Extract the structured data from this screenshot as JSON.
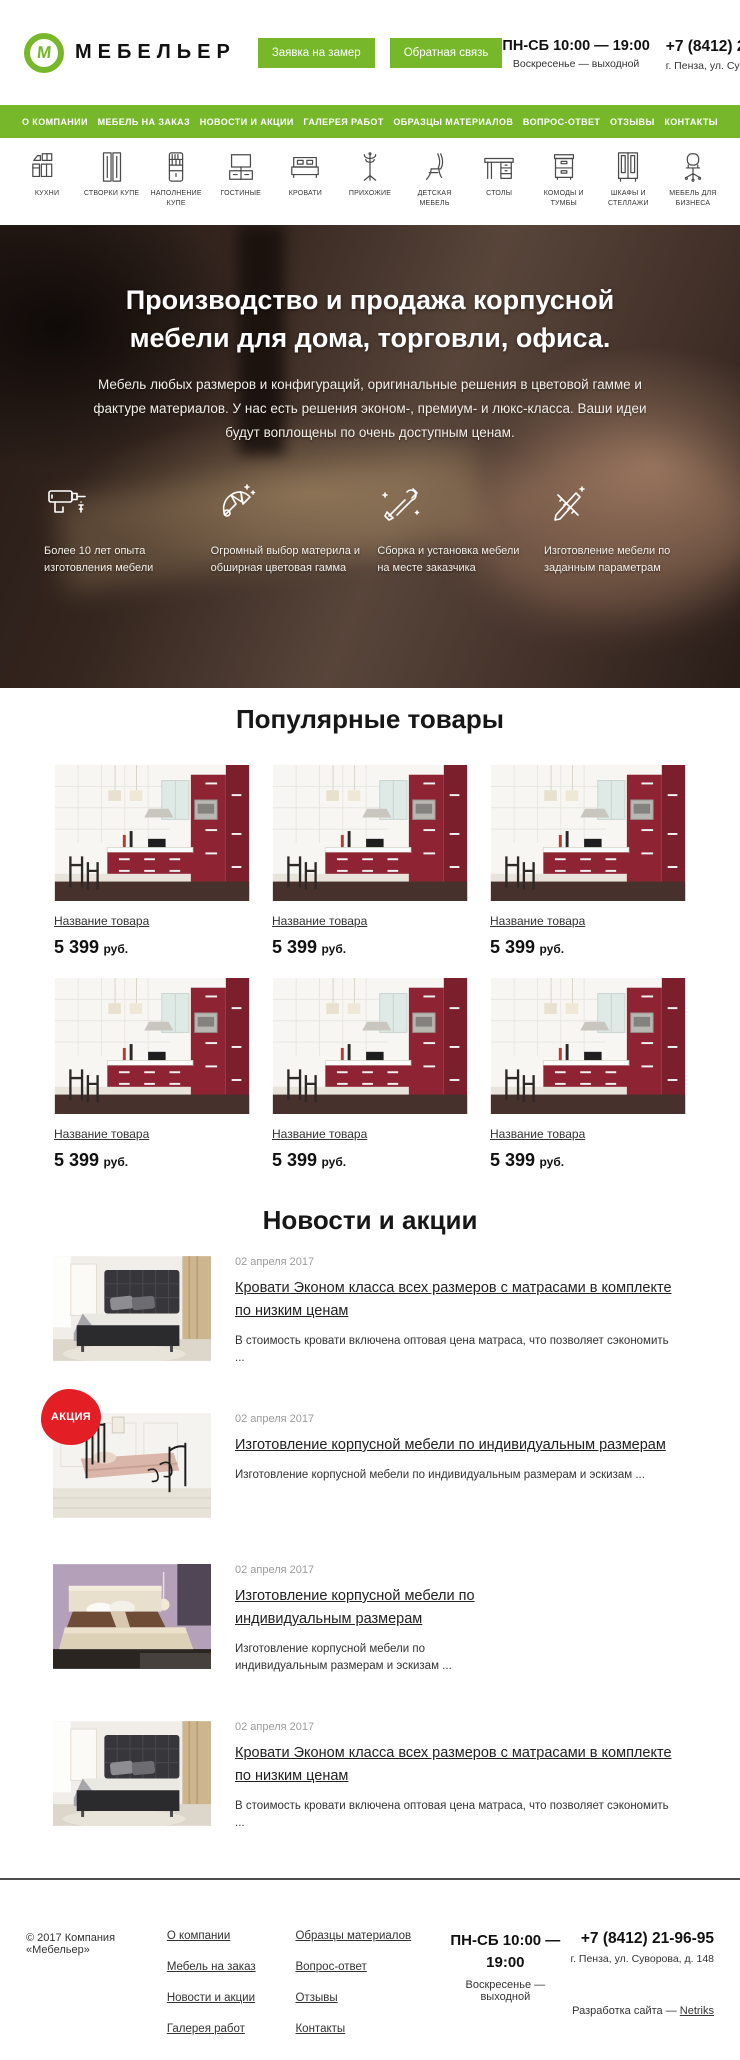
{
  "colors": {
    "accent": "#76b82a",
    "badge": "#e31e24"
  },
  "header": {
    "logo_letter": "М",
    "brand": "МЕБЕЛЬЕР",
    "buttons": {
      "measure": "Заявка на замер",
      "feedback": "Обратная связь"
    },
    "schedule": {
      "line1": "ПН-СБ 10:00 — 19:00",
      "line2": "Воскресенье — выходной"
    },
    "phone": "+7 (8412) 21-96-95",
    "address": "г. Пенза, ул. Суворова, д. 148"
  },
  "nav": {
    "items": [
      "О КОМПАНИИ",
      "МЕБЕЛЬ НА ЗАКАЗ",
      "НОВОСТИ И АКЦИИ",
      "ГАЛЕРЕЯ РАБОТ",
      "ОБРАЗЦЫ МАТЕРИАЛОВ",
      "ВОПРОС-ОТВЕТ",
      "ОТЗЫВЫ",
      "КОНТАКТЫ"
    ]
  },
  "categories": {
    "items": [
      {
        "label": "КУХНИ",
        "icon": "kitchen-icon"
      },
      {
        "label": "СТВОРКИ КУПЕ",
        "icon": "sliding-doors-icon"
      },
      {
        "label": "НАПОЛНЕНИЕ КУПЕ",
        "icon": "shelving-icon"
      },
      {
        "label": "ГОСТИНЫЕ",
        "icon": "tv-stand-icon"
      },
      {
        "label": "КРОВАТИ",
        "icon": "bed-icon"
      },
      {
        "label": "ПРИХОЖИЕ",
        "icon": "coat-rack-icon"
      },
      {
        "label": "ДЕТСКАЯ МЕБЕЛЬ",
        "icon": "chair-icon"
      },
      {
        "label": "СТОЛЫ",
        "icon": "desk-icon"
      },
      {
        "label": "КОМОДЫ И ТУМБЫ",
        "icon": "drawers-icon"
      },
      {
        "label": "ШКАФЫ И СТЕЛЛАЖИ",
        "icon": "wardrobe-icon"
      },
      {
        "label": "МЕБЕЛЬ ДЛЯ БИЗНЕСА",
        "icon": "office-chair-icon"
      }
    ]
  },
  "hero": {
    "title": "Производство и продажа корпусной мебели для дома, торговли, офиса.",
    "subtitle": "Мебель любых размеров и конфигураций, оригинальные решения в цветовой гамме и фактуре материалов. У нас есть решения эконом-, премиум- и люкс-класса. Ваши идеи будут воплощены по очень доступным ценам.",
    "features": [
      {
        "icon": "drill-icon",
        "text": "Более 10 лет опыта изготовления мебели"
      },
      {
        "icon": "color-fan-icon",
        "text": "Огромный выбор материла и обширная цветовая гамма"
      },
      {
        "icon": "tools-icon",
        "text": "Сборка и установка мебели на месте заказчика"
      },
      {
        "icon": "drafting-icon",
        "text": "Изготовление мебели по заданным параметрам"
      }
    ]
  },
  "products": {
    "title": "Популярные товары",
    "items": [
      {
        "name": "Название товара",
        "price": "5 399",
        "currency": "руб."
      },
      {
        "name": "Название товара",
        "price": "5 399",
        "currency": "руб."
      },
      {
        "name": "Название товара",
        "price": "5 399",
        "currency": "руб."
      },
      {
        "name": "Название товара",
        "price": "5 399",
        "currency": "руб."
      },
      {
        "name": "Название товара",
        "price": "5 399",
        "currency": "руб."
      },
      {
        "name": "Название товара",
        "price": "5 399",
        "currency": "руб."
      }
    ]
  },
  "news": {
    "title": "Новости и акции",
    "items": [
      {
        "date": "02 апреля 2017",
        "title": "Кровати Эконом класса всех размеров с матрасами в комплекте по низким ценам",
        "excerpt": "В стоимость кровати включена оптовая цена матраса, что позволяет сэкономить ...",
        "badge": ""
      },
      {
        "date": "02 апреля 2017",
        "title": "Изготовление корпусной мебели по индивидуальным размерам",
        "excerpt": "Изготовление корпусной мебели по индивидуальным размерам и эскизам ...",
        "badge": "АКЦИЯ"
      },
      {
        "date": "02 апреля 2017",
        "title": "Изготовление корпусной мебели по индивидуальным размерам",
        "excerpt": "Изготовление корпусной мебели по индивидуальным размерам и эскизам ...",
        "badge": ""
      },
      {
        "date": "02 апреля 2017",
        "title": "Кровати Эконом класса всех размеров с матрасами в комплекте по низким ценам",
        "excerpt": "В стоимость кровати включена оптовая цена матраса, что позволяет сэкономить ...",
        "badge": ""
      }
    ]
  },
  "footer": {
    "copyright": "© 2017 Компания «Мебельер»",
    "links_col1": [
      "О компании",
      "Мебель на заказ",
      "Новости и акции",
      "Галерея работ"
    ],
    "links_col2": [
      "Образцы материалов",
      "Вопрос-ответ",
      "Отзывы",
      "Контакты"
    ],
    "schedule": {
      "line1": "ПН-СБ 10:00 — 19:00",
      "line2": "Воскресенье — выходной"
    },
    "phone": "+7 (8412) 21-96-95",
    "address": "г. Пенза, ул. Суворова, д. 148",
    "credits": {
      "prefix": "Разработка сайта — ",
      "link": "Netriks"
    }
  }
}
